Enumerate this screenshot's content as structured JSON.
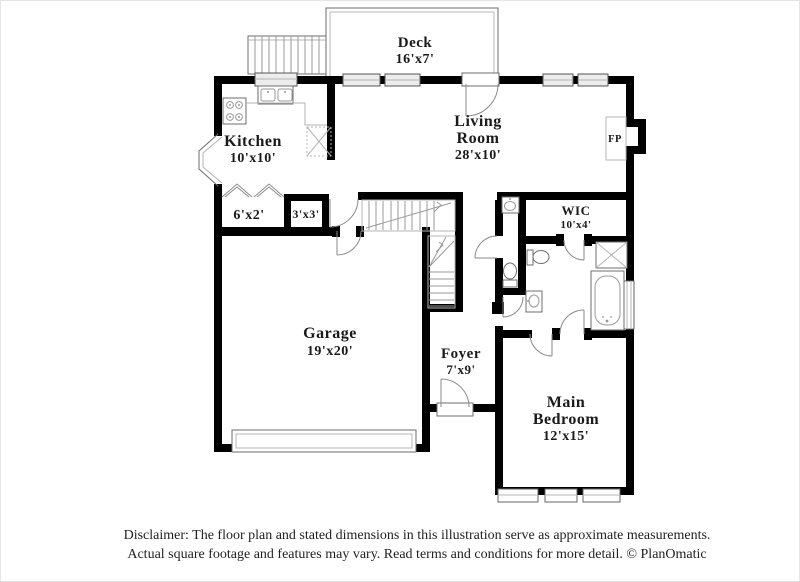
{
  "plan": {
    "rooms": {
      "deck": {
        "name": "Deck",
        "dims": "16'x7'"
      },
      "kitchen": {
        "name": "Kitchen",
        "dims": "10'x10'"
      },
      "living": {
        "name_line1": "Living",
        "name_line2": "Room",
        "dims": "28'x10'"
      },
      "wic": {
        "name": "WIC",
        "dims": "10'x4'"
      },
      "closet_a": {
        "dims": "6'x2'"
      },
      "closet_b": {
        "dims": "3'x3'"
      },
      "garage": {
        "name": "Garage",
        "dims": "19'x20'"
      },
      "foyer": {
        "name": "Foyer",
        "dims": "7'x9'"
      },
      "bedroom": {
        "name_line1": "Main",
        "name_line2": "Bedroom",
        "dims": "12'x15'"
      },
      "fireplace": {
        "abbr": "FP"
      }
    },
    "disclaimer": {
      "line1": "Disclaimer: The floor plan and stated dimensions in this illustration serve as approximate measurements.",
      "line2": "Actual square footage and features may vary. Read terms and conditions for more detail. © PlanOmatic"
    },
    "colors": {
      "wall": "#000000",
      "fixture_stroke": "#6e6e6e",
      "window_fill": "#ececec",
      "text": "#1a1a1a"
    }
  }
}
